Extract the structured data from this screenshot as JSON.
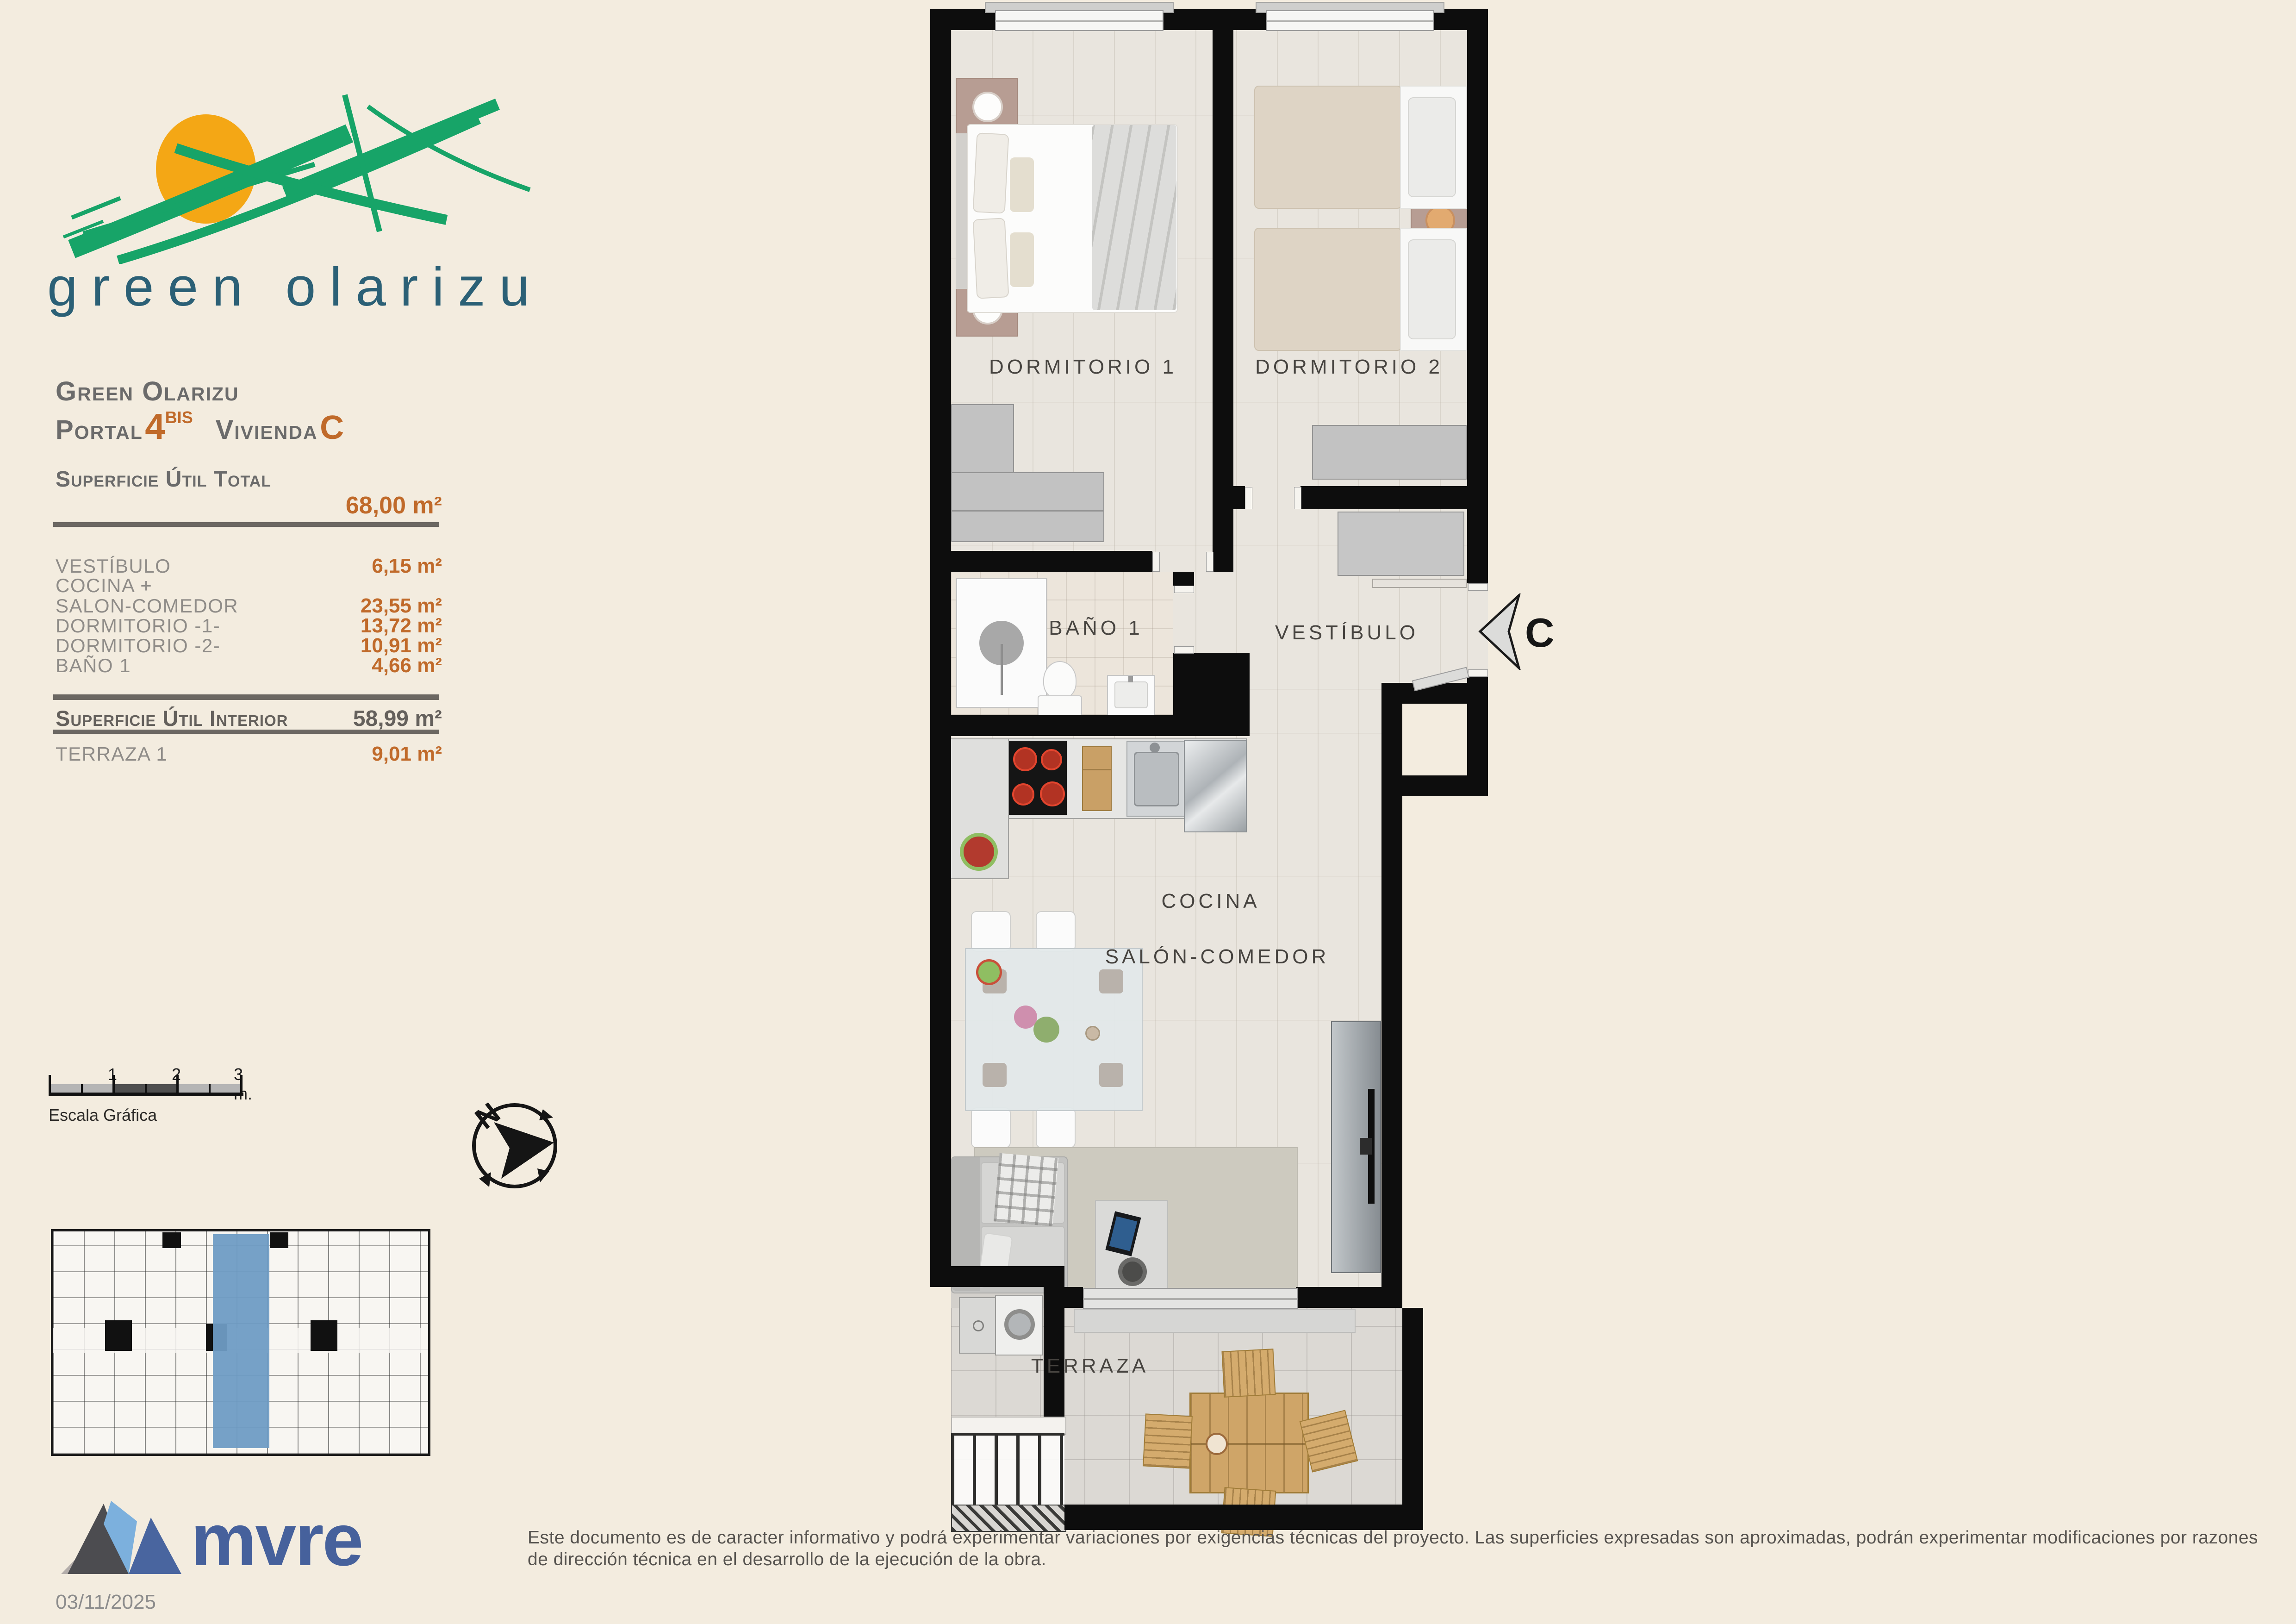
{
  "logo": {
    "wordmark": "green olarizu"
  },
  "header": {
    "project": "Green Olarizu",
    "portal_label": "Portal",
    "portal_number": "4",
    "portal_suffix": "BIS",
    "unit_label": "Vivienda",
    "unit_letter": "C"
  },
  "areas": {
    "total_label": "Superficie Útil Total",
    "total_value": "68,00 m²",
    "rows": [
      {
        "label": "VESTÍBULO",
        "value": "6,15 m²"
      },
      {
        "label": "COCINA +",
        "value": ""
      },
      {
        "label": "SALON-COMEDOR",
        "value": "23,55 m²"
      },
      {
        "label": "DORMITORIO -1-",
        "value": "13,72 m²"
      },
      {
        "label": "DORMITORIO -2-",
        "value": "10,91 m²"
      },
      {
        "label": "BAÑO 1",
        "value": "4,66 m²"
      }
    ],
    "interior_label": "Superficie Útil Interior",
    "interior_value": "58,99 m²",
    "terrace_label": "TERRAZA 1",
    "terrace_value": "9,01 m²"
  },
  "scalebar": {
    "tick1": "1",
    "tick2": "2",
    "tick3": "3 m.",
    "caption": "Escala Gráfica"
  },
  "compass": {
    "north": "N"
  },
  "plan": {
    "rooms": {
      "dorm1": "DORMITORIO 1",
      "dorm2": "DORMITORIO 2",
      "bano": "BAÑO 1",
      "vestibulo": "VESTÍBULO",
      "cocina": "COCINA",
      "salon": "SALÓN-COMEDOR",
      "terraza": "TERRAZA"
    },
    "unit_marker": "C"
  },
  "footer": {
    "brand": "mvre",
    "date": "03/11/2025",
    "disclaimer": "Este documento es de caracter informativo y podrá experimentar variaciones por exigencias técnicas del proyecto. Las superficies expresadas son aproximadas, podrán experimentar modificaciones por razones de dirección técnica en el desarrollo de la ejecución de la obra."
  },
  "colors": {
    "background": "#f3ecdf",
    "accent_orange": "#c06a2a",
    "text_gray": "#6b6b6b",
    "logo_green": "#17a468",
    "logo_sun": "#f4a715",
    "logo_teal": "#2b6076",
    "brand_blue": "#46619c",
    "unit_highlight_blue": "#6f9cc4"
  }
}
